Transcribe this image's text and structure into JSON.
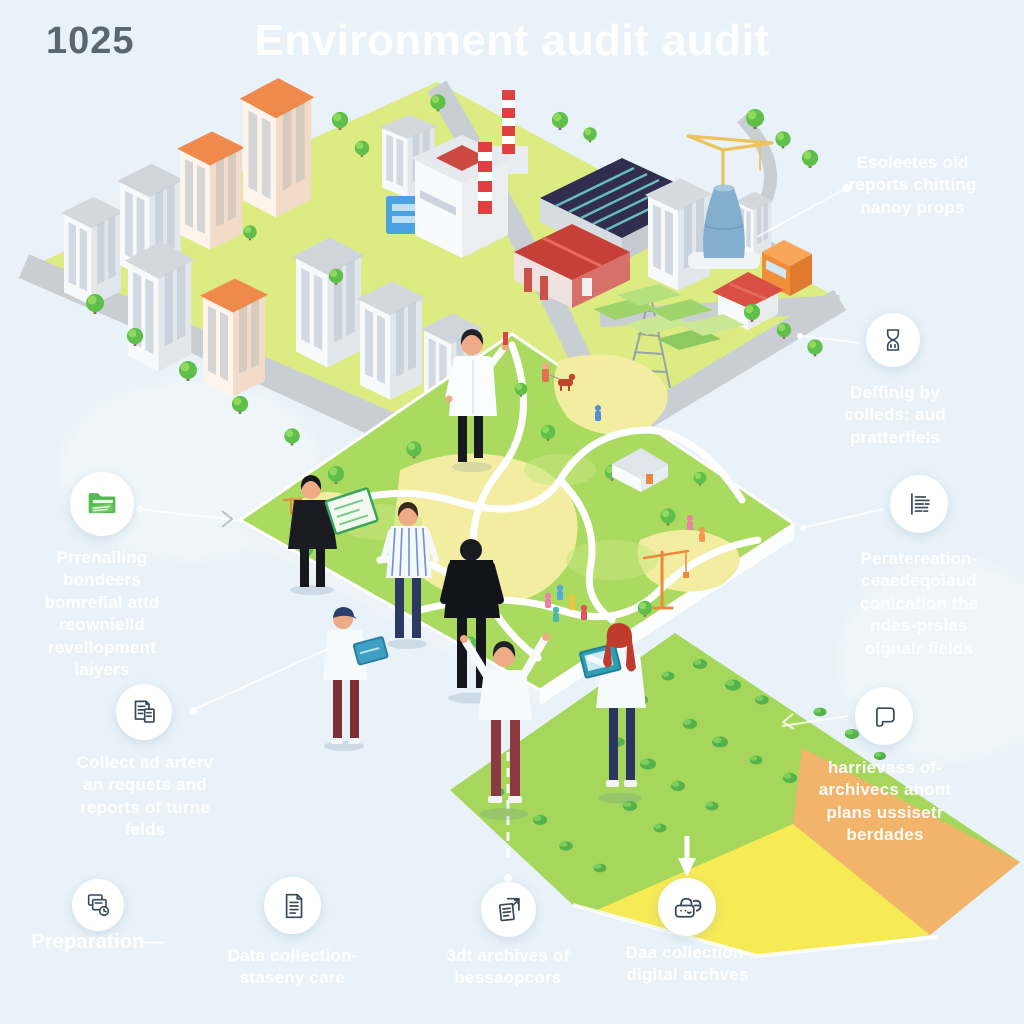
{
  "header": {
    "number": "1025",
    "title": "Environment audit audit"
  },
  "colors": {
    "background": "#e9f2f8",
    "title": "#ffffff",
    "number": "#5b6770",
    "label": "#ffffff",
    "circle": "#ffffff",
    "icon_stroke": "#37495a",
    "folder_green": "#55ba51",
    "city_ground": "#dcec83",
    "road": "#c9ced3",
    "roof_orange": "#f08a4c",
    "roof_gray": "#d3d8dd",
    "park_green": "#aada5f",
    "field_green": "#a6d65c",
    "field_orange": "#f2b36a",
    "field_yellow": "#f6ea55",
    "tree_green": "#5fbf4a"
  },
  "callouts": {
    "explore": {
      "icon": null,
      "text": "Esoleetes oid\nreports chitting\nnanoy props"
    },
    "hourglass": {
      "icon": "hourglass-icon",
      "text": "Deffinig by\ncolleds: aud\npratterfiels"
    },
    "report": {
      "icon": "report-lines-icon",
      "text": "Peratereation-\nceaedeqoiaud\nconication the\nndes-prsias\noignair fields"
    },
    "speech": {
      "icon": "speech-bubble-icon",
      "text": "harrievass of-\narchivecs anont\nplans ussisetr\nberdades"
    },
    "folder": {
      "icon": "green-folder-icon",
      "text": "Prrenalling\nbondeers\nbomrefial attd\nreownielld\nrevellopment\nlaiyers"
    },
    "collect": {
      "icon": "documents-icon",
      "text": "Collect ad arterv\nan requets and\nreports of turne\nfelds"
    },
    "preparation": {
      "icon": "folders-clock-icon",
      "text": "Preparation—"
    },
    "data_collection": {
      "icon": "document-text-icon",
      "text": "Data collection-\nstaseny care"
    },
    "archives": {
      "icon": "document-arrow-icon",
      "text": "3dt archives of\nbessaopcors"
    },
    "digital": {
      "icon": "satchel-lock-icon",
      "text": "Daa collection-\ndigital archves"
    }
  }
}
